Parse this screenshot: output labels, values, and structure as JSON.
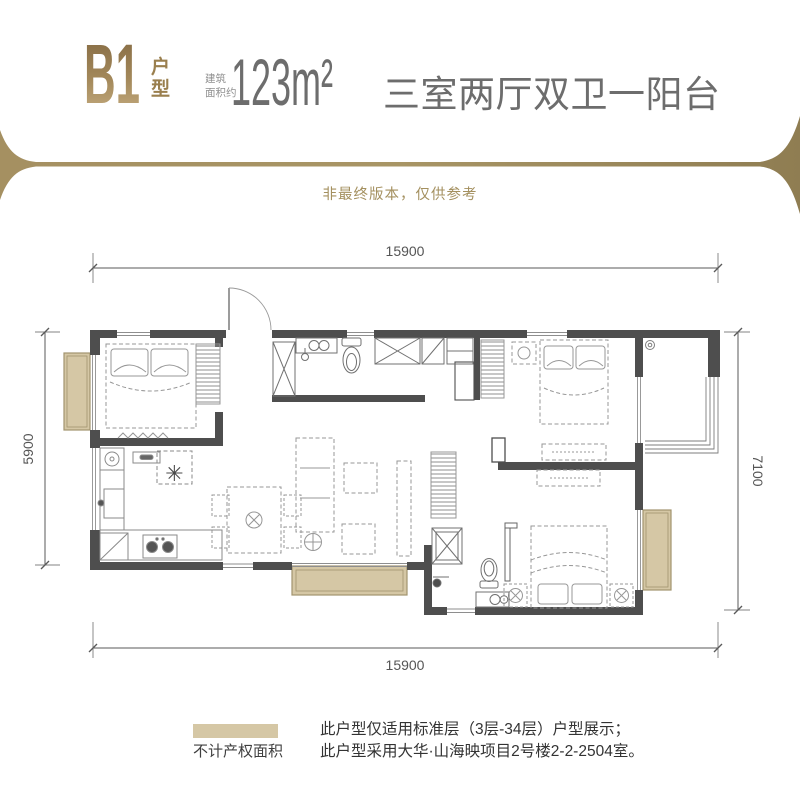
{
  "header": {
    "type_code": "B1",
    "type_suffix": "户型",
    "area_label_line1": "建筑",
    "area_label_line2": "面积约",
    "area_value": "123m²",
    "layout_title": "三室两厅双卫一阳台",
    "gold_color": "#9a7f4e",
    "text_color": "#6d6d6d"
  },
  "disclaimer": {
    "text": "非最终版本，仅供参考",
    "color": "#a4905f"
  },
  "floorplan": {
    "dimensions": {
      "top": "15900",
      "bottom": "15900",
      "left": "5900",
      "right": "7100"
    },
    "wall_color": "#4e4e4e",
    "non_property_area_color": "#d5c7a5",
    "stove_symbol": "✳"
  },
  "legend": {
    "label": "不计产权面积",
    "swatch_color": "#d5c7a5"
  },
  "notes": {
    "line1": "此户型仅适用标准层（3层-34层）户型展示；",
    "line2": "此户型采用大华·山海映项目2号楼2-2-2504室。"
  }
}
